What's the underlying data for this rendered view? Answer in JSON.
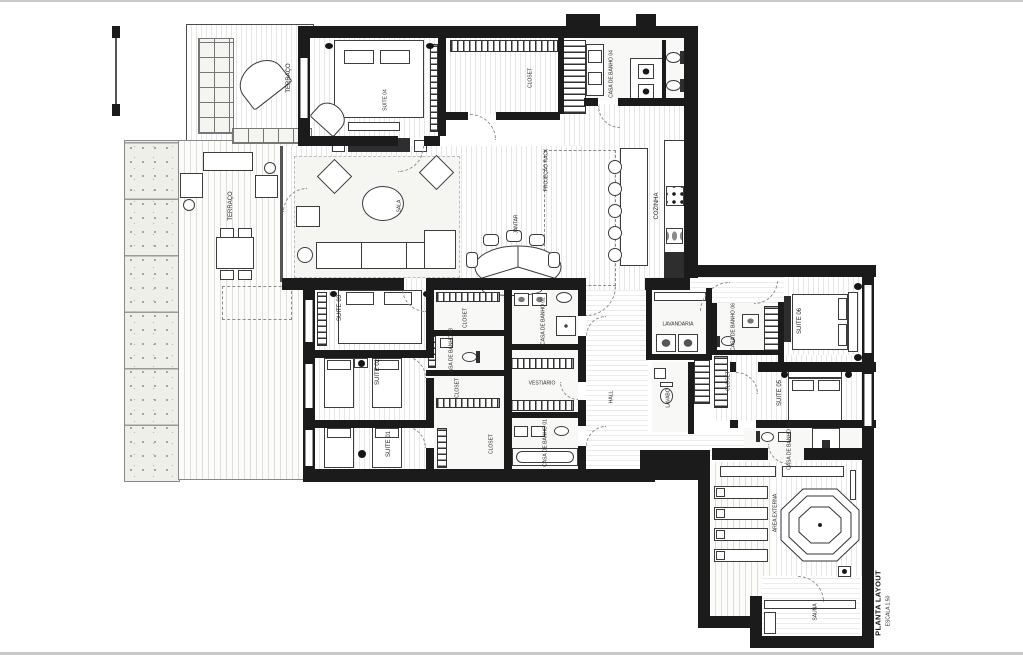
{
  "document": {
    "kind": "architectural floor plan (scanned drawing)",
    "title": "PLANTA LAYOUT",
    "scale": "ESCALA 1:50"
  },
  "colors": {
    "wall": "#1b1b1b",
    "paper": "#ffffff",
    "floor_line": "#e6e6e6"
  },
  "labels": {
    "terraco_top": "TERRAÇO",
    "terraco": "TERRAÇO",
    "suite04": "SUITE 04",
    "closet_corredor": "CLOSET",
    "cb04": "CASA DE BANHO 04",
    "sala": "SALA",
    "jantar": "JANTAR",
    "proj": "PROJEÇÃO RACK",
    "cozinha": "COZINHA",
    "suite03": "SUITE 03",
    "closet_s03": "CLOSET",
    "cb03": "CASA DE BANHO 03",
    "cb02": "CASA DE BANHO 02",
    "suite02": "SUITE 02",
    "closet_s02": "CLOSET",
    "vestiario": "VESTIÁRIO",
    "suite01": "SUITE 01",
    "closet_s01": "CLOSET",
    "cb01": "CASA DE BANHO 01",
    "hall": "HALL",
    "lavandaria": "LAVANDARIA",
    "lavabo": "LAVABO",
    "cb06": "CASA DE BANHO 06",
    "suite06": "SUITE 06",
    "closet_s05": "CLOSET",
    "suite05": "SUITE 05",
    "cb05": "CASA DE BANHO 05",
    "area_externa": "ÁREA EXTERNA",
    "sauna": "SAUNA"
  }
}
